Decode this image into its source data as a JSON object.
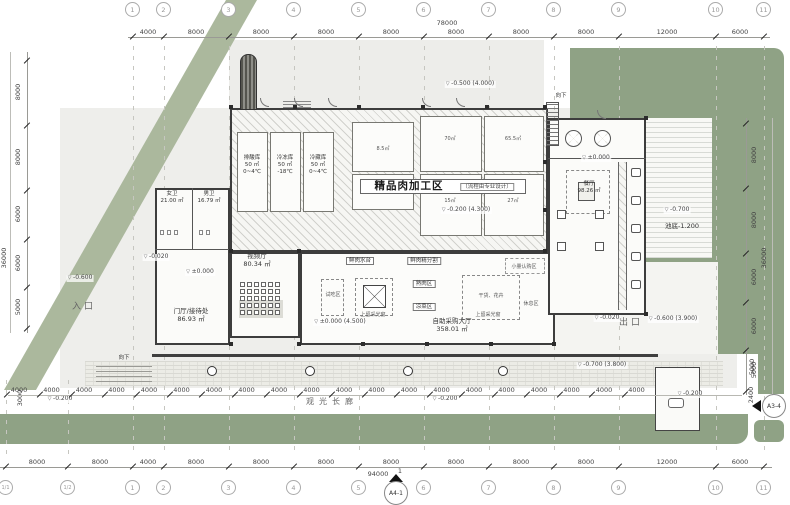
{
  "colors": {
    "green_strip": "#abb89d",
    "green_block": "#8fa285",
    "site_bg": "#ededea",
    "wall": "#3d3d3d",
    "hatch_bg": "#f6f6f3"
  },
  "title": {
    "zone": "精品肉加工区",
    "zone_note": "（流程由专业设计）"
  },
  "markers": {
    "bottom": "A4-1",
    "right": "A3-4"
  },
  "grid_top": {
    "bubbles": [
      {
        "l": "1",
        "x": 133
      },
      {
        "l": "2",
        "x": 164
      },
      {
        "l": "3",
        "x": 229
      },
      {
        "l": "4",
        "x": 294
      },
      {
        "l": "5",
        "x": 359
      },
      {
        "l": "6",
        "x": 424
      },
      {
        "l": "7",
        "x": 489
      },
      {
        "l": "8",
        "x": 554
      },
      {
        "l": "9",
        "x": 619
      },
      {
        "l": "10",
        "x": 716
      },
      {
        "l": "11",
        "x": 764
      }
    ],
    "dims": [
      {
        "l": "4000",
        "x": 148
      },
      {
        "l": "8000",
        "x": 196
      },
      {
        "l": "8000",
        "x": 261
      },
      {
        "l": "8000",
        "x": 326
      },
      {
        "l": "8000",
        "x": 391
      },
      {
        "l": "8000",
        "x": 456
      },
      {
        "l": "8000",
        "x": 521
      },
      {
        "l": "8000",
        "x": 586
      },
      {
        "l": "12000",
        "x": 667
      },
      {
        "l": "6000",
        "x": 740
      }
    ],
    "total": "78000"
  },
  "grid_bottom": {
    "bubbles": [
      {
        "l": "1/1",
        "x": 6,
        "s": 1
      },
      {
        "l": "1/2",
        "x": 68,
        "s": 1
      },
      {
        "l": "1",
        "x": 133
      },
      {
        "l": "2",
        "x": 164
      },
      {
        "l": "3",
        "x": 229
      },
      {
        "l": "4",
        "x": 294
      },
      {
        "l": "5",
        "x": 359
      },
      {
        "l": "6",
        "x": 424
      },
      {
        "l": "7",
        "x": 489
      },
      {
        "l": "8",
        "x": 554
      },
      {
        "l": "9",
        "x": 619
      },
      {
        "l": "10",
        "x": 716
      },
      {
        "l": "11",
        "x": 764
      }
    ],
    "dims": [
      {
        "l": "8000",
        "x": 37
      },
      {
        "l": "8000",
        "x": 100
      },
      {
        "l": "4000",
        "x": 148
      },
      {
        "l": "8000",
        "x": 196
      },
      {
        "l": "8000",
        "x": 261
      },
      {
        "l": "8000",
        "x": 326
      },
      {
        "l": "8000",
        "x": 391
      },
      {
        "l": "8000",
        "x": 456
      },
      {
        "l": "8000",
        "x": 521
      },
      {
        "l": "8000",
        "x": 586
      },
      {
        "l": "12000",
        "x": 667
      },
      {
        "l": "6000",
        "x": 740
      }
    ],
    "total": "94000",
    "section_num": "1"
  },
  "grid_left": {
    "dims": [
      {
        "l": "8000",
        "y": 92
      },
      {
        "l": "8000",
        "y": 157
      },
      {
        "l": "6000",
        "y": 214
      },
      {
        "l": "6000",
        "y": 263
      },
      {
        "l": "5000",
        "y": 307
      }
    ],
    "ticks": [
      60,
      125,
      190,
      239,
      287,
      328
    ],
    "total": "36000"
  },
  "grid_right": {
    "dims": [
      {
        "l": "8000",
        "y": 155
      },
      {
        "l": "8000",
        "y": 220
      },
      {
        "l": "6000",
        "y": 277
      },
      {
        "l": "6000",
        "y": 326
      },
      {
        "l": "5000",
        "y": 370
      }
    ],
    "ticks": [
      123,
      188,
      253,
      302,
      350,
      391
    ],
    "total": "36000"
  },
  "colonnade": {
    "label": "4000",
    "count": 20
  },
  "video_hall": {
    "rows": 5,
    "cols": 6
  },
  "columns_round": [
    212,
    310,
    408,
    503
  ],
  "columns_sq": [
    [
      229,
      105
    ],
    [
      293,
      105
    ],
    [
      357,
      105
    ],
    [
      421,
      105
    ],
    [
      485,
      105
    ],
    [
      543,
      105
    ],
    [
      229,
      249
    ],
    [
      297,
      249
    ],
    [
      543,
      249
    ],
    [
      229,
      342
    ],
    [
      297,
      342
    ],
    [
      361,
      342
    ],
    [
      425,
      342
    ],
    [
      489,
      342
    ],
    [
      552,
      342
    ],
    [
      644,
      116
    ],
    [
      644,
      312
    ],
    [
      543,
      160
    ],
    [
      543,
      208
    ]
  ],
  "labels": [
    {
      "t": "入口",
      "x": 84,
      "y": 303,
      "c": "entry",
      "n": "entrance-label"
    },
    {
      "t": "出口",
      "x": 631,
      "y": 319,
      "c": "entry",
      "n": "exit-label"
    },
    {
      "t": "观光长廊",
      "x": 332,
      "y": 398,
      "c": "corridor",
      "n": "corridor-label"
    },
    {
      "t": "向下",
      "x": 561,
      "y": 93,
      "c": "xs",
      "n": "down-label"
    },
    {
      "t": "向下",
      "x": 124,
      "y": 355,
      "c": "xs",
      "n": "down-label"
    },
    {
      "t": "视频厅",
      "x": 257,
      "y": 253,
      "c": "sm",
      "n": "video-hall-label"
    },
    {
      "t": "80.34 ㎡",
      "x": 257,
      "y": 261,
      "c": "sm",
      "n": "video-hall-area"
    },
    {
      "t": "女卫",
      "x": 172,
      "y": 191,
      "c": "xs",
      "n": "women-wc-label"
    },
    {
      "t": "21.00 ㎡",
      "x": 172,
      "y": 198,
      "c": "xs",
      "n": "women-wc-area"
    },
    {
      "t": "男卫",
      "x": 209,
      "y": 191,
      "c": "xs",
      "n": "men-wc-label"
    },
    {
      "t": "16.79 ㎡",
      "x": 209,
      "y": 198,
      "c": "xs",
      "n": "men-wc-area"
    },
    {
      "t": "门厅/接待处",
      "x": 191,
      "y": 308,
      "c": "sm",
      "n": "lobby-label"
    },
    {
      "t": "86.93 ㎡",
      "x": 191,
      "y": 316,
      "c": "sm",
      "n": "lobby-area"
    },
    {
      "t": "自助采购大厅",
      "x": 452,
      "y": 318,
      "c": "sm",
      "n": "market-hall-label"
    },
    {
      "t": "358.01 ㎡",
      "x": 452,
      "y": 326,
      "c": "sm",
      "n": "market-hall-area"
    },
    {
      "t": "餐厅",
      "x": 589,
      "y": 181,
      "c": "xs",
      "n": "dining-label"
    },
    {
      "t": "98.26 ㎡",
      "x": 589,
      "y": 188,
      "c": "xs",
      "n": "dining-area"
    },
    {
      "t": "排酸库",
      "x": 252,
      "y": 155,
      "c": "xs"
    },
    {
      "t": "50 ㎡",
      "x": 252,
      "y": 162,
      "c": "xs"
    },
    {
      "t": "0~4℃",
      "x": 252,
      "y": 169,
      "c": "xs"
    },
    {
      "t": "冷冻库",
      "x": 285,
      "y": 155,
      "c": "xs"
    },
    {
      "t": "50 ㎡",
      "x": 285,
      "y": 162,
      "c": "xs"
    },
    {
      "t": "-18℃",
      "x": 285,
      "y": 169,
      "c": "xs"
    },
    {
      "t": "冷藏库",
      "x": 318,
      "y": 155,
      "c": "xs"
    },
    {
      "t": "50 ㎡",
      "x": 318,
      "y": 162,
      "c": "xs"
    },
    {
      "t": "0~4℃",
      "x": 318,
      "y": 169,
      "c": "xs"
    },
    {
      "t": "8.5㎡",
      "x": 383,
      "y": 147,
      "c": "xxs"
    },
    {
      "t": "70㎡",
      "x": 450,
      "y": 137,
      "c": "xxs"
    },
    {
      "t": "65.5㎡",
      "x": 513,
      "y": 137,
      "c": "xxs"
    },
    {
      "t": "15㎡",
      "x": 450,
      "y": 199,
      "c": "xxs"
    },
    {
      "t": "27㎡",
      "x": 513,
      "y": 199,
      "c": "xxs"
    },
    {
      "t": "鲜肉水台",
      "x": 360,
      "y": 257,
      "c": "boxed"
    },
    {
      "t": "鲜肉精分割",
      "x": 424,
      "y": 257,
      "c": "boxed"
    },
    {
      "t": "熟肉区",
      "x": 424,
      "y": 280,
      "c": "boxed"
    },
    {
      "t": "凉菜区",
      "x": 424,
      "y": 303,
      "c": "boxed"
    },
    {
      "t": "干货、花卉",
      "x": 491,
      "y": 294,
      "c": "xxs"
    },
    {
      "t": "上留采光窗",
      "x": 373,
      "y": 313,
      "c": "xxs"
    },
    {
      "t": "上留采光窗",
      "x": 488,
      "y": 313,
      "c": "xxs"
    },
    {
      "t": "试吃区",
      "x": 333,
      "y": 293,
      "c": "xxs"
    },
    {
      "t": "小量认购区",
      "x": 524,
      "y": 265,
      "c": "xxs"
    },
    {
      "t": "休息区",
      "x": 531,
      "y": 302,
      "c": "xxs"
    },
    {
      "t": "-0.700",
      "x": 677,
      "y": 207,
      "c": "elev"
    },
    {
      "t": "池底-1.200",
      "x": 682,
      "y": 223,
      "c": "sm"
    },
    {
      "t": "-0.500 (4.000)",
      "x": 470,
      "y": 81,
      "c": "elev"
    },
    {
      "t": "-0.200 (4.300)",
      "x": 466,
      "y": 207,
      "c": "elev"
    },
    {
      "t": "±0.000 (4.500)",
      "x": 340,
      "y": 319,
      "c": "elev"
    },
    {
      "t": "±0.000",
      "x": 200,
      "y": 269,
      "c": "elev"
    },
    {
      "t": "±0.000",
      "x": 596,
      "y": 155,
      "c": "elev"
    },
    {
      "t": "-0.020",
      "x": 156,
      "y": 254,
      "c": "elev"
    },
    {
      "t": "-0.020",
      "x": 607,
      "y": 315,
      "c": "elev"
    },
    {
      "t": "-0.600",
      "x": 80,
      "y": 275,
      "c": "elev"
    },
    {
      "t": "-0.600 (3.900)",
      "x": 673,
      "y": 316,
      "c": "elev"
    },
    {
      "t": "-0.700 (3.800)",
      "x": 602,
      "y": 362,
      "c": "elev"
    },
    {
      "t": "-0.200",
      "x": 60,
      "y": 396,
      "c": "elev"
    },
    {
      "t": "-0.200",
      "x": 445,
      "y": 396,
      "c": "elev"
    },
    {
      "t": "-0.200",
      "x": 690,
      "y": 391,
      "c": "elev"
    },
    {
      "t": "3000",
      "x": 20,
      "y": 398,
      "c": "vd"
    },
    {
      "t": "5000",
      "x": 752,
      "y": 367,
      "c": "vd"
    },
    {
      "t": "2400",
      "x": 751,
      "y": 395,
      "c": "vd"
    }
  ]
}
